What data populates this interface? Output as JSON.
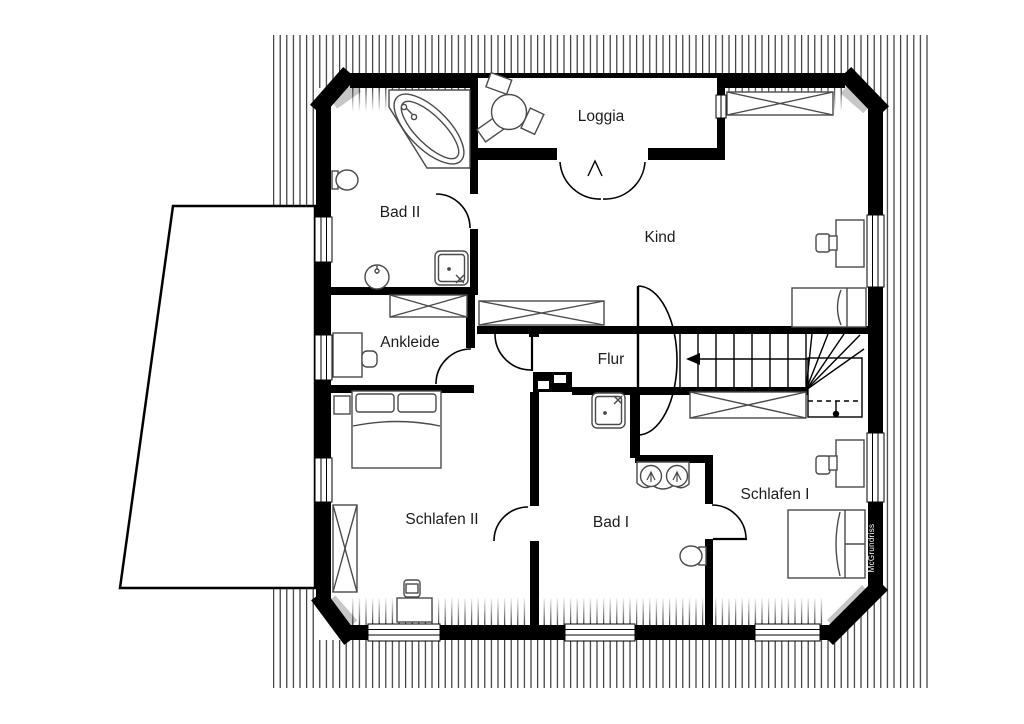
{
  "document": {
    "type": "architectural-floor-plan",
    "style": "black-and-white catalog plan"
  },
  "watermark": "McGrundriss",
  "colors": {
    "walls": "#000000",
    "background": "#ffffff",
    "hatch_lines": "#2e2e2e",
    "furniture_stroke": "#4a4a4a"
  },
  "rooms": [
    {
      "label": "Bad II"
    },
    {
      "label": "Loggia"
    },
    {
      "label": "Kind"
    },
    {
      "label": "Ankleide"
    },
    {
      "label": "Flur"
    },
    {
      "label": "Schlafen II"
    },
    {
      "label": "Bad I"
    },
    {
      "label": "Schlafen I"
    }
  ],
  "icons": {
    "bathtub": "corner-bathtub-icon",
    "shower": "shower-tray-icon",
    "toilet": "toilet-icon",
    "washbasin": "washbasin-icon",
    "double_washbasin": "double-washbasin-icon",
    "bed": "double-bed-icon",
    "wardrobe": "crossed-wardrobe-icon",
    "desk": "desk-with-chair-icon",
    "stairs": "staircase-with-winder-icon",
    "table": "round-table-with-chairs-icon",
    "direction_arrow": "stair-direction-arrow-icon"
  }
}
